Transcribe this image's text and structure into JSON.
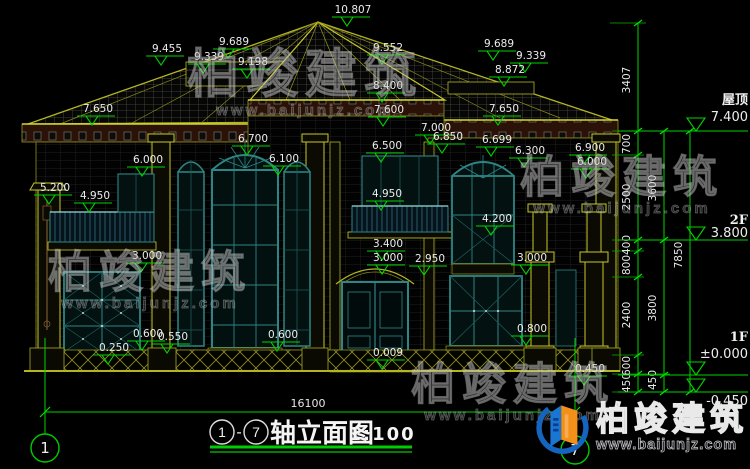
{
  "watermark": {
    "brand": "柏竣建筑",
    "url": "www.baijunjz.com"
  },
  "logo": {
    "brand": "柏竣建筑",
    "url": "www.baijunjz.com"
  },
  "footer": {
    "axis_left": "1",
    "axis_right": "7",
    "sep": "-",
    "title": "轴立面图",
    "scale": "1:100",
    "total_width": "16100"
  },
  "elevation_labels": [
    {
      "t": "10.807",
      "x": 353,
      "y": 13
    },
    {
      "t": "9.455",
      "x": 167,
      "y": 52
    },
    {
      "t": "9.689",
      "x": 234,
      "y": 45
    },
    {
      "t": "9.339",
      "x": 209,
      "y": 60
    },
    {
      "t": "9.198",
      "x": 253,
      "y": 65
    },
    {
      "t": "9.552",
      "x": 388,
      "y": 51
    },
    {
      "t": "8.400",
      "x": 388,
      "y": 89
    },
    {
      "t": "9.689",
      "x": 499,
      "y": 47
    },
    {
      "t": "9.339",
      "x": 531,
      "y": 59
    },
    {
      "t": "8.872",
      "x": 510,
      "y": 73
    },
    {
      "t": "7.650",
      "x": 98,
      "y": 112
    },
    {
      "t": "7.650",
      "x": 504,
      "y": 112
    },
    {
      "t": "7.600",
      "x": 389,
      "y": 113
    },
    {
      "t": "7.000",
      "x": 436,
      "y": 131
    },
    {
      "t": "6.850",
      "x": 448,
      "y": 140
    },
    {
      "t": "6.699",
      "x": 497,
      "y": 143
    },
    {
      "t": "6.700",
      "x": 253,
      "y": 142
    },
    {
      "t": "6.500",
      "x": 387,
      "y": 149
    },
    {
      "t": "6.300",
      "x": 530,
      "y": 154
    },
    {
      "t": "6.100",
      "x": 284,
      "y": 162
    },
    {
      "t": "6.000",
      "x": 148,
      "y": 163
    },
    {
      "t": "6.900",
      "x": 590,
      "y": 151
    },
    {
      "t": "6.000",
      "x": 592,
      "y": 165
    },
    {
      "t": "5.200",
      "x": 55,
      "y": 191
    },
    {
      "t": "4.950",
      "x": 95,
      "y": 199
    },
    {
      "t": "4.950",
      "x": 387,
      "y": 197
    },
    {
      "t": "4.200",
      "x": 497,
      "y": 222
    },
    {
      "t": "3.400",
      "x": 388,
      "y": 247
    },
    {
      "t": "3.000",
      "x": 388,
      "y": 261
    },
    {
      "t": "2.950",
      "x": 430,
      "y": 262
    },
    {
      "t": "3.000",
      "x": 147,
      "y": 259
    },
    {
      "t": "3.000",
      "x": 532,
      "y": 261
    },
    {
      "t": "0.600",
      "x": 148,
      "y": 337
    },
    {
      "t": "0.550",
      "x": 173,
      "y": 340
    },
    {
      "t": "0.250",
      "x": 114,
      "y": 351
    },
    {
      "t": "0.600",
      "x": 283,
      "y": 338
    },
    {
      "t": "0.800",
      "x": 532,
      "y": 332
    },
    {
      "t": "0.009",
      "x": 388,
      "y": 356
    },
    {
      "t": "0.450",
      "x": 590,
      "y": 372
    }
  ],
  "dim_chains": [
    {
      "labels": [
        {
          "t": "3407",
          "x": 630,
          "y": 80
        },
        {
          "t": "700",
          "x": 630,
          "y": 144
        },
        {
          "t": "2500",
          "x": 630,
          "y": 197
        },
        {
          "t": "400",
          "x": 630,
          "y": 245
        },
        {
          "t": "800",
          "x": 630,
          "y": 265
        },
        {
          "t": "2400",
          "x": 630,
          "y": 315
        },
        {
          "t": "600",
          "x": 630,
          "y": 366
        },
        {
          "t": "450",
          "x": 630,
          "y": 383
        }
      ]
    },
    {
      "labels": [
        {
          "t": "3600",
          "x": 656,
          "y": 188
        },
        {
          "t": "3800",
          "x": 656,
          "y": 308
        },
        {
          "t": "450",
          "x": 656,
          "y": 380
        }
      ]
    },
    {
      "labels": [
        {
          "t": "7850",
          "x": 682,
          "y": 255
        }
      ]
    }
  ],
  "levels": [
    {
      "label": "屋顶",
      "value": "7.400",
      "y": 131,
      "lty": 104,
      "vty": 121
    },
    {
      "label": "2F",
      "value": "3.800",
      "y": 240,
      "lty": 224,
      "vty": 237
    },
    {
      "label": "1F",
      "value": "±0.000",
      "y": 375,
      "lty": 341,
      "vty": 358
    },
    {
      "label": "",
      "value": "-0.450",
      "y": 392,
      "lty": 0,
      "vty": 405
    }
  ]
}
